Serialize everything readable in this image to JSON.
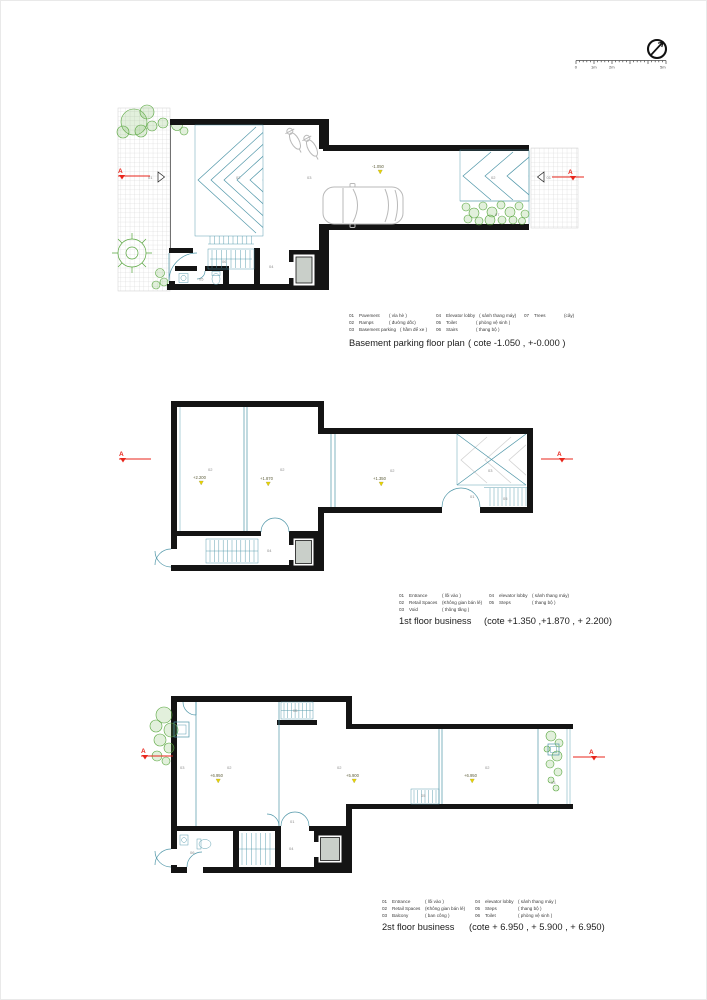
{
  "colors": {
    "wall": "#141414",
    "plan_line_teal": "#4f96a8",
    "vegetation_green": "#56a53c",
    "section_red": "#e8251b",
    "level_marker_yellow": "#e9d400",
    "vehicle_gray": "#b9b9b9",
    "elevator_fill": "#c9cfc9",
    "pavement_grid": "#cfcfcf"
  },
  "icons": {
    "compass": "north-arrow-icon"
  },
  "scale_bar": {
    "ticks": [
      "0",
      "1m",
      "2m",
      "5m"
    ]
  },
  "plans": {
    "basement": {
      "title": "Basement parking floor plan",
      "cote": "( cote -1.050 , +-0.000 )",
      "section": "A",
      "labels": {
        "entry_left": "01",
        "ramp": "02",
        "parking": "03",
        "lobby": "04",
        "toilet": "05",
        "stairs": "06",
        "ramp_right": "02",
        "trees": "07",
        "entry_right": "01"
      },
      "levels": {
        "parking": "-1.050"
      },
      "legend": [
        {
          "num": "01",
          "en": "Pavement",
          "vi": "( vỉa hè )"
        },
        {
          "num": "02",
          "en": "Ramps",
          "vi": "( đường dốc)"
        },
        {
          "num": "03",
          "en": "Basement parking",
          "vi": "( hầm để xe )"
        },
        {
          "num": "04",
          "en": "Elevator lobby",
          "vi": "( sảnh thang máy)"
        },
        {
          "num": "05",
          "en": "Toilet",
          "vi": "( phòng vệ sinh )"
        },
        {
          "num": "06",
          "en": "Stairs",
          "vi": "( thang bộ )"
        },
        {
          "num": "07",
          "en": "Trees",
          "vi": "(cây)"
        }
      ]
    },
    "first_floor": {
      "title": "1st floor business",
      "cote": "(cote +1.350 ,+1.870 , + 2.200)",
      "section": "A",
      "labels": {
        "retail_1": "02",
        "retail_2": "02",
        "retail_3": "02",
        "void": "03",
        "entrance": "01",
        "steps": "05",
        "lobby": "04"
      },
      "levels": {
        "retail_1": "+2.200",
        "retail_2": "+1.870",
        "retail_3": "+1.350"
      },
      "legend": [
        {
          "num": "01",
          "en": "Entrance",
          "vi": "( lối vào )"
        },
        {
          "num": "02",
          "en": "Retail Spaces",
          "vi": "(Không gian bán lẻ)"
        },
        {
          "num": "03",
          "en": "Void",
          "vi": "( thông tầng )"
        },
        {
          "num": "04",
          "en": "elevator lobby",
          "vi": "( sảnh thang máy)"
        },
        {
          "num": "05",
          "en": "Steps",
          "vi": "( thang bộ )"
        }
      ]
    },
    "second_floor": {
      "title": "2st floor business",
      "cote": "(cote + 6.950 , + 5.900 , + 6.950)",
      "section": "A",
      "labels": {
        "balcony_left": "03",
        "retail_1": "02",
        "retail_2": "02",
        "retail_3": "02",
        "balcony_right": "03",
        "steps_top": "05",
        "steps_mid": "05",
        "entrance": "01",
        "toilet": "06",
        "lobby": "04"
      },
      "levels": {
        "retail_1": "+6.950",
        "retail_2": "+5.900",
        "retail_3": "+6.950"
      },
      "legend": [
        {
          "num": "01",
          "en": "Entrance",
          "vi": "( lối vào )"
        },
        {
          "num": "02",
          "en": "Retail Spaces",
          "vi": "(Không gian bán lẻ)"
        },
        {
          "num": "03",
          "en": "Balcony",
          "vi": "( ban công )"
        },
        {
          "num": "04",
          "en": "elevator lobby",
          "vi": "( sảnh thang máy )"
        },
        {
          "num": "05",
          "en": "Steps",
          "vi": "( thang bộ )"
        },
        {
          "num": "06",
          "en": "Toilet",
          "vi": "( phòng vệ sinh )"
        }
      ]
    }
  }
}
